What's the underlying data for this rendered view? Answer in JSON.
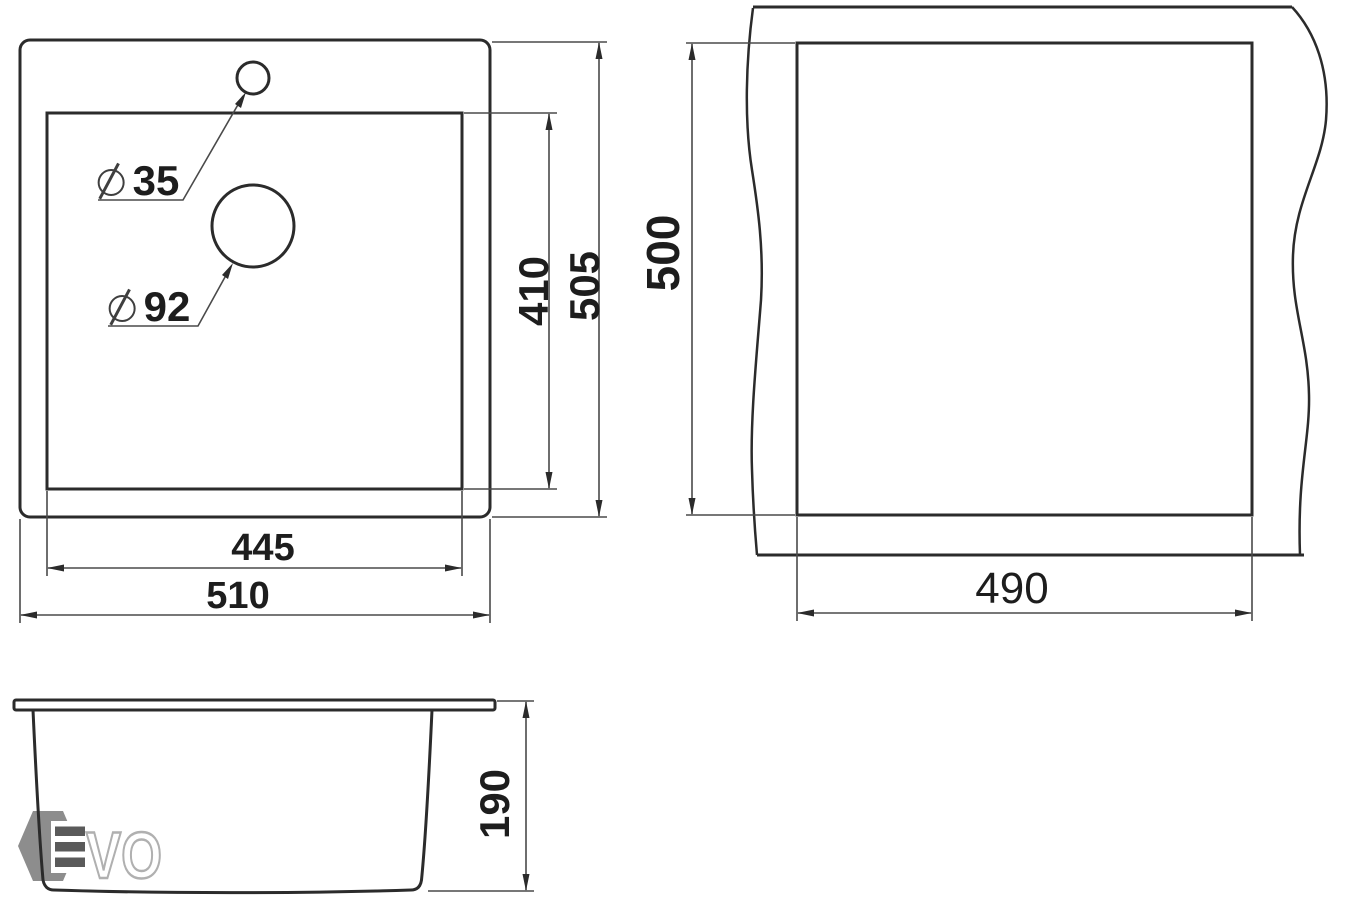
{
  "views": {
    "top": {
      "overall_width": "510",
      "overall_depth": "505",
      "bowl_width": "445",
      "bowl_depth": "410",
      "faucet_hole_diameter": "35",
      "drain_hole_diameter": "92"
    },
    "cutout": {
      "width": "490",
      "height": "500"
    },
    "side": {
      "depth": "190"
    }
  },
  "logo": {
    "vo": "VO"
  },
  "colors": {
    "outline": "#2b2b2b",
    "dimension_line": "#4a4a4a",
    "text": "#1d1d1d",
    "logo_hexagon": "#8d8d8d",
    "logo_bars": "#5a5a5a",
    "logo_letter_outline": "#b0b0b0"
  }
}
